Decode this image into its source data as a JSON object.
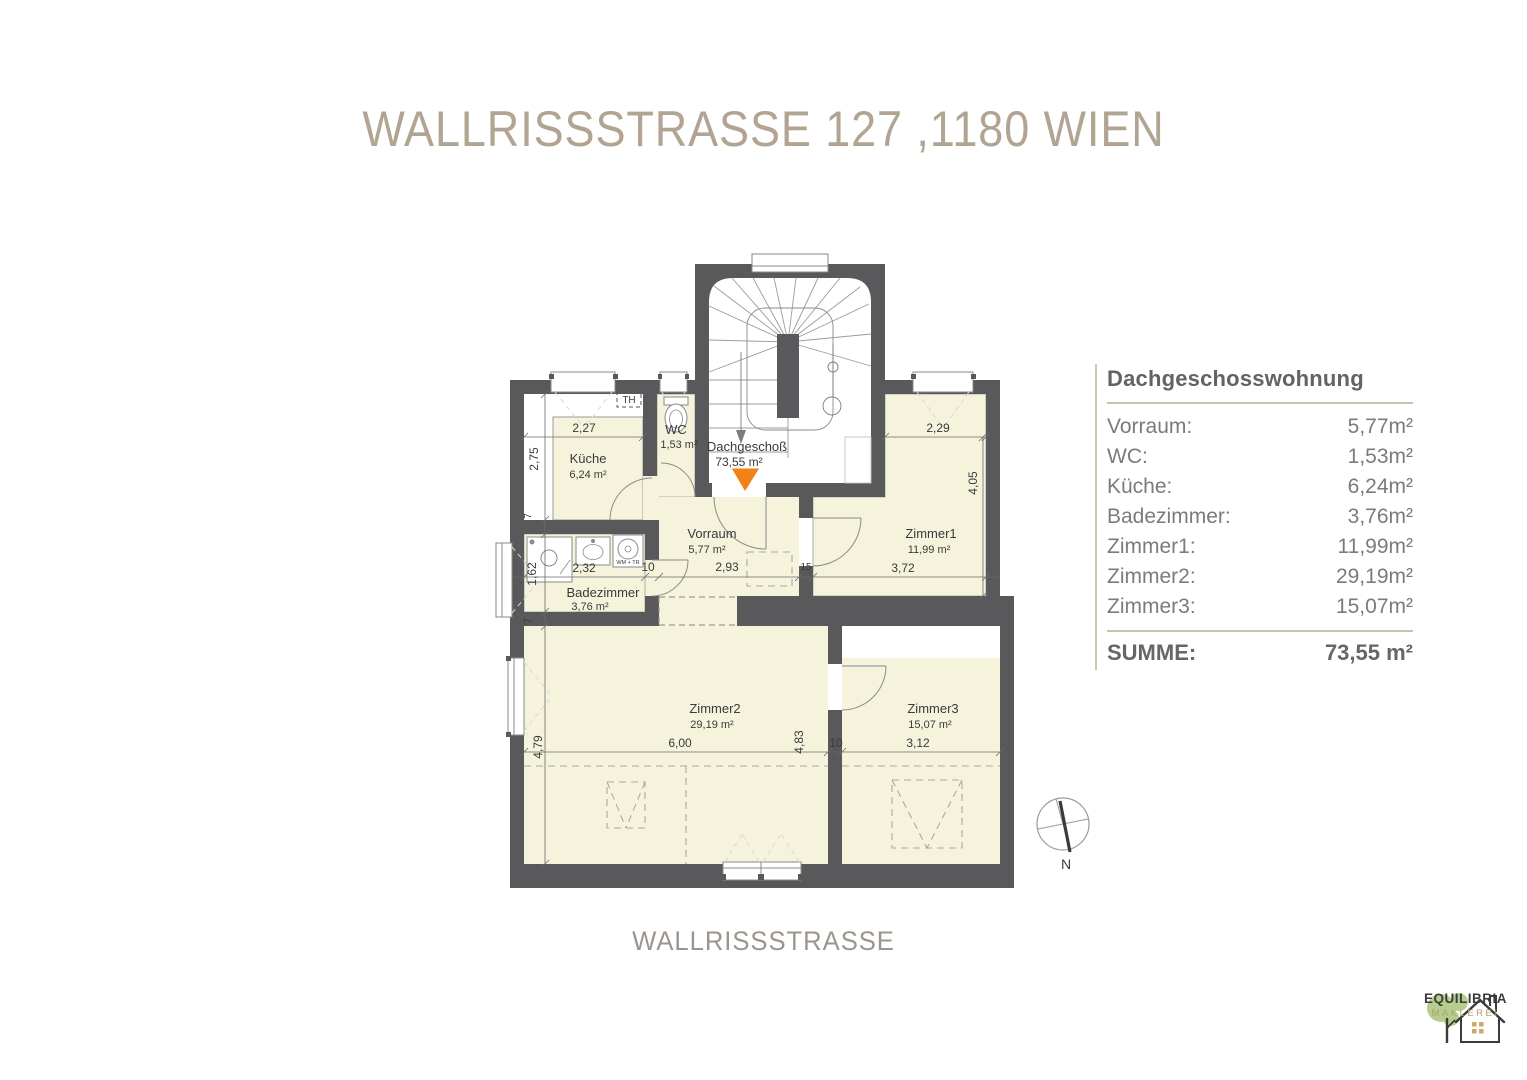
{
  "title": "WALLRISSSTRASSE 127 ,1180 WIEN",
  "street_label": "WALLRISSSTRASSE",
  "legend": {
    "title": "Dachgeschosswohnung",
    "rows": [
      {
        "label": "Vorraum:",
        "value": "5,77m²"
      },
      {
        "label": "WC:",
        "value": "1,53m²"
      },
      {
        "label": "Küche:",
        "value": "6,24m²"
      },
      {
        "label": "Badezimmer:",
        "value": "3,76m²"
      },
      {
        "label": "Zimmer1:",
        "value": "11,99m²"
      },
      {
        "label": "Zimmer2:",
        "value": "29,19m²"
      },
      {
        "label": "Zimmer3:",
        "value": "15,07m²"
      }
    ],
    "sum_label": "SUMME:",
    "sum_value": "73,55 m²"
  },
  "plan": {
    "floor_label": "Dachgeschoß",
    "floor_area": "73,55 m²",
    "rooms": [
      {
        "name": "Küche",
        "area": "6,24 m²"
      },
      {
        "name": "WC",
        "area": "1,53 m²"
      },
      {
        "name": "Vorraum",
        "area": "5,77 m²"
      },
      {
        "name": "Badezimmer",
        "area": "3,76 m²"
      },
      {
        "name": "Zimmer1",
        "area": "11,99 m²"
      },
      {
        "name": "Zimmer2",
        "area": "29,19 m²"
      },
      {
        "name": "Zimmer3",
        "area": "15,07 m²"
      }
    ],
    "dims": {
      "kueche_w": "2,27",
      "kueche_h": "2,75",
      "zimmer1_top": "2,29",
      "zimmer1_right": "4,05",
      "bad_h": "1,62",
      "bad_w": "2,32",
      "wall_10_a": "10",
      "vorraum_w": "2,93",
      "wall_15": "15",
      "zimmer1_bottom": "3,72",
      "zimmer2_left": "4,79",
      "zimmer2_w": "6,00",
      "zimmer2_right": "4,83",
      "wall_10_b": "10",
      "zimmer3_w": "3,12",
      "wall_7_a": "7",
      "wall_7_b": "7"
    },
    "annotations": {
      "th": "TH",
      "wm_tr": "WM + TR"
    },
    "compass_label": "N"
  },
  "logo": {
    "name": "EQUILIBRIA",
    "subtitle": "MAKLEREI"
  },
  "colors": {
    "wall": "#59595c",
    "room_fill": "#f6f3dd",
    "accent_orange": "#f08218",
    "title_text": "#b2a492"
  }
}
